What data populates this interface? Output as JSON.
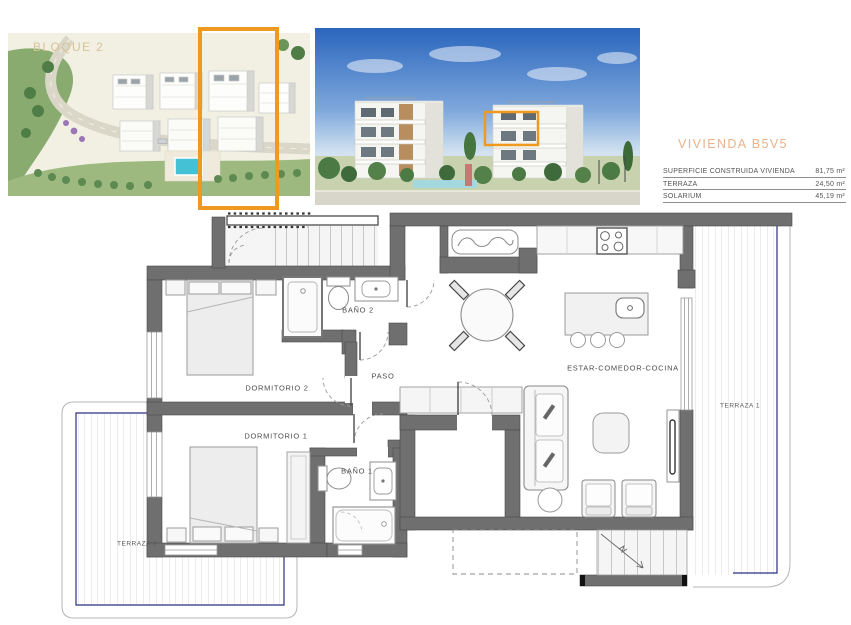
{
  "colors": {
    "accent_orange": "#F0991F",
    "caption_tan": "#D8C398",
    "title_peach": "#EAB28A",
    "wall_gray": "#6F6F6F",
    "terrace_blue": "#2B2E83",
    "pool_blue": "#45C1D6",
    "label_gray": "#4D4D4D"
  },
  "photos": {
    "aerial": {
      "caption": "BLOQUE 2"
    },
    "street": {}
  },
  "unit": {
    "title": "VIVIENDA B5V5",
    "specs": [
      {
        "label": "SUPERFICIE CONSTRUIDA VIVIENDA",
        "value": "81,75 m²"
      },
      {
        "label": "TERRAZA",
        "value": "24,50 m²"
      },
      {
        "label": "SOLARIUM",
        "value": "45,19 m²"
      }
    ]
  },
  "plan": {
    "rooms": [
      {
        "id": "bano2",
        "label": "BAÑO 2"
      },
      {
        "id": "dormitorio2",
        "label": "DORMITORIO 2"
      },
      {
        "id": "paso",
        "label": "PASO"
      },
      {
        "id": "estar",
        "label": "ESTAR-COMEDOR-COCINA"
      },
      {
        "id": "dormitorio1",
        "label": "DORMITORIO 1"
      },
      {
        "id": "bano1",
        "label": "BAÑO 1"
      },
      {
        "id": "terraza1",
        "label": "TERRAZA 1"
      },
      {
        "id": "terraza2",
        "label": "TERRAZA 2"
      }
    ]
  }
}
